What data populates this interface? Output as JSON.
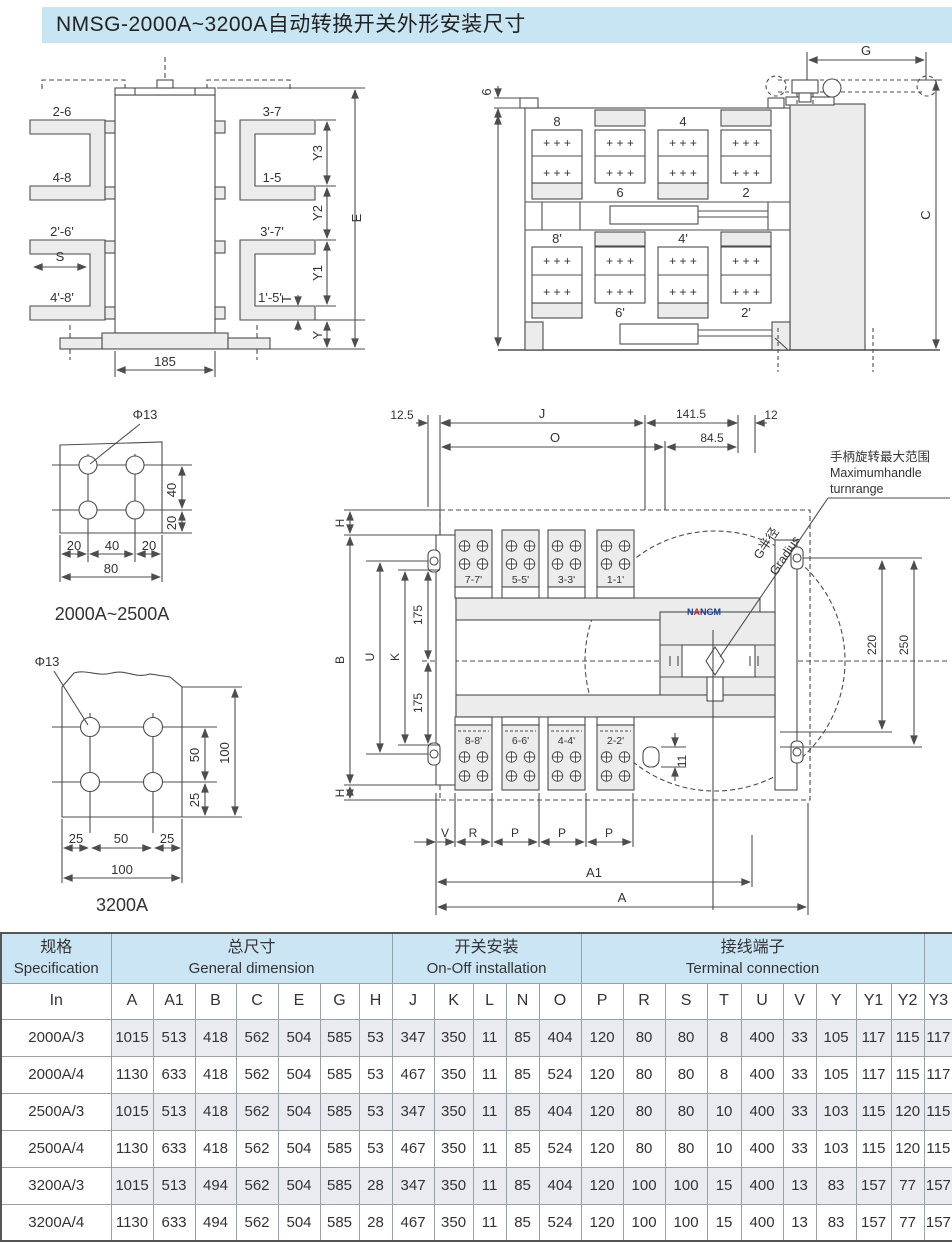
{
  "title": "NMSG-2000A~3200A自动转换开关外形安装尺寸",
  "logo": {
    "p1": "N",
    "p2": "A",
    "p3": "NGM"
  },
  "d1": {
    "l26": "2-6",
    "l37": "3-7",
    "l48": "4-8",
    "l15": "1-5",
    "l26p": "2'-6'",
    "l37p": "3'-7'",
    "l48p": "4'-8'",
    "l15p": "1'-5'",
    "s": "S",
    "w185": "185",
    "y3": "Y3",
    "y2": "Y2",
    "y1": "Y1",
    "e": "E",
    "t": "T",
    "y": "Y"
  },
  "d2": {
    "g": "G",
    "c": "C",
    "six": "6",
    "plus": "+  +  +",
    "b8": "8",
    "b4": "4",
    "b6": "6",
    "b2": "2",
    "b8p": "8'",
    "b4p": "4'",
    "b6p": "6'",
    "b2p": "2'"
  },
  "d3": {
    "hole": "Φ13",
    "v40": "40",
    "v20": "20",
    "h20a": "20",
    "h40": "40",
    "h20b": "20",
    "h80": "80",
    "caption": "2000A~2500A"
  },
  "d4": {
    "hole": "Φ13",
    "v50": "50",
    "v25": "25",
    "v100": "100",
    "h25a": "25",
    "h50": "50",
    "h25b": "25",
    "h100": "100",
    "caption": "3200A"
  },
  "d5": {
    "d125": "12.5",
    "j": "J",
    "d1415": "141.5",
    "d12": "12",
    "o": "O",
    "d845": "84.5",
    "h": "H",
    "b": "B",
    "u": "U",
    "k": "K",
    "d175a": "175",
    "d175b": "175",
    "d220": "220",
    "d250": "250",
    "d11": "11",
    "v": "V",
    "r": "R",
    "p1": "P",
    "p2": "P",
    "p3": "P",
    "a1": "A1",
    "a": "A",
    "t77": "7-7'",
    "t55": "5-5'",
    "t33": "3-3'",
    "t11": "1-1'",
    "t88": "8-8'",
    "t66": "6-6'",
    "t44": "4-4'",
    "t22": "2-2'",
    "note1": "手柄旋转最大范围",
    "note2": "Maximumhandle",
    "note3": "turnrange",
    "gr1": "G半径",
    "gr2": "Gradius"
  },
  "table": {
    "groups": {
      "spec_cn": "规格",
      "spec_en": "Specification",
      "gen_cn": "总尺寸",
      "gen_en": "General dimension",
      "inst_cn": "开关安装",
      "inst_en": "On-Off installation",
      "term_cn": "接线端子",
      "term_en": "Terminal connection"
    },
    "columns": [
      "In",
      "A",
      "A1",
      "B",
      "C",
      "E",
      "G",
      "H",
      "J",
      "K",
      "L",
      "N",
      "O",
      "P",
      "R",
      "S",
      "T",
      "U",
      "V",
      "Y",
      "Y1",
      "Y2",
      "Y3"
    ],
    "rows": [
      [
        "2000A/3",
        1015,
        513,
        418,
        562,
        504,
        585,
        53,
        347,
        350,
        11,
        85,
        404,
        120,
        80,
        80,
        8,
        400,
        33,
        105,
        117,
        115,
        117
      ],
      [
        "2000A/4",
        1130,
        633,
        418,
        562,
        504,
        585,
        53,
        467,
        350,
        11,
        85,
        524,
        120,
        80,
        80,
        8,
        400,
        33,
        105,
        117,
        115,
        117
      ],
      [
        "2500A/3",
        1015,
        513,
        418,
        562,
        504,
        585,
        53,
        347,
        350,
        11,
        85,
        404,
        120,
        80,
        80,
        10,
        400,
        33,
        103,
        115,
        120,
        115
      ],
      [
        "2500A/4",
        1130,
        633,
        418,
        562,
        504,
        585,
        53,
        467,
        350,
        11,
        85,
        524,
        120,
        80,
        80,
        10,
        400,
        33,
        103,
        115,
        120,
        115
      ],
      [
        "3200A/3",
        1015,
        513,
        494,
        562,
        504,
        585,
        28,
        347,
        350,
        11,
        85,
        404,
        120,
        100,
        100,
        15,
        400,
        13,
        83,
        157,
        77,
        157
      ],
      [
        "3200A/4",
        1130,
        633,
        494,
        562,
        504,
        585,
        28,
        467,
        350,
        11,
        85,
        524,
        120,
        100,
        100,
        15,
        400,
        13,
        83,
        157,
        77,
        157
      ]
    ]
  }
}
